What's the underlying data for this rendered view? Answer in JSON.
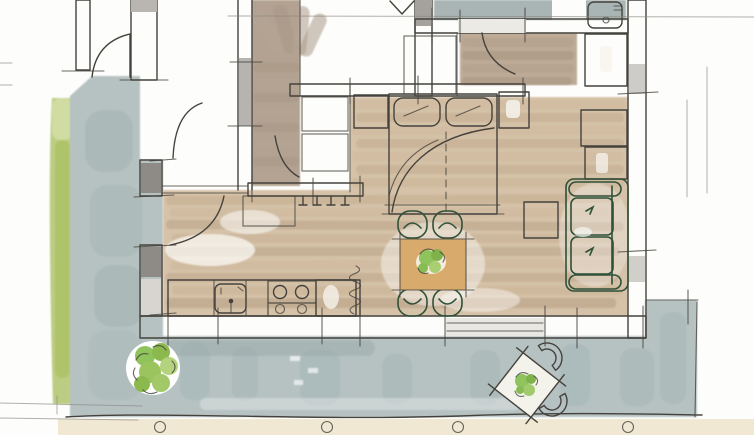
{
  "drawing": {
    "kind": "hand-drawn watercolor apartment floor plan sketch",
    "rooms": [
      "bedroom",
      "bathroom",
      "hallway",
      "living-dining-area",
      "kitchen",
      "terrace",
      "garden-strip",
      "gravel-walk"
    ],
    "furniture": {
      "bedroom": [
        "double-bed",
        "two-pillows",
        "nightstand-left",
        "nightstand-right",
        "wardrobe-units"
      ],
      "hallway": [
        "hall-closet",
        "coat-hooks",
        "sideboard"
      ],
      "kitchen": [
        "counter",
        "sink",
        "stove-with-burners",
        "tall-cabinet",
        "radiator-squiggle"
      ],
      "living": [
        "dining-table",
        "four-green-chairs",
        "table-plant",
        "green-sofa"
      ],
      "terrace": [
        "patio-bistro-table",
        "two-patio-chairs",
        "patio-plant",
        "shrub",
        "fence-posts"
      ]
    }
  },
  "palette": {
    "paper": "#fdfdfb",
    "pencil": "#45423c",
    "wall_dark": "#8e8a85",
    "wall_light": "#d8d5d1",
    "grass": "#bccd83",
    "grass_dark": "#a9c05f",
    "terrace": "#b6c2c2",
    "terrace_shadow": "#9fb0b0",
    "wood_light": "#d5c2a8",
    "wood_dark": "#c0a78c",
    "hall_taupe": "#b3a291",
    "bath_gray": "#a9b5b4",
    "counter_gray": "#b2c0c4",
    "tan": "#dcb67f",
    "table_tan": "#d8ab6c",
    "chair_green": "#bdd3b6",
    "sofa_green": "#9dc79c",
    "cushion_green": "#61a06f",
    "plant_green": "#8fc35c",
    "gravel": "#f1e8d4",
    "post_tan": "#e0bf8b"
  }
}
